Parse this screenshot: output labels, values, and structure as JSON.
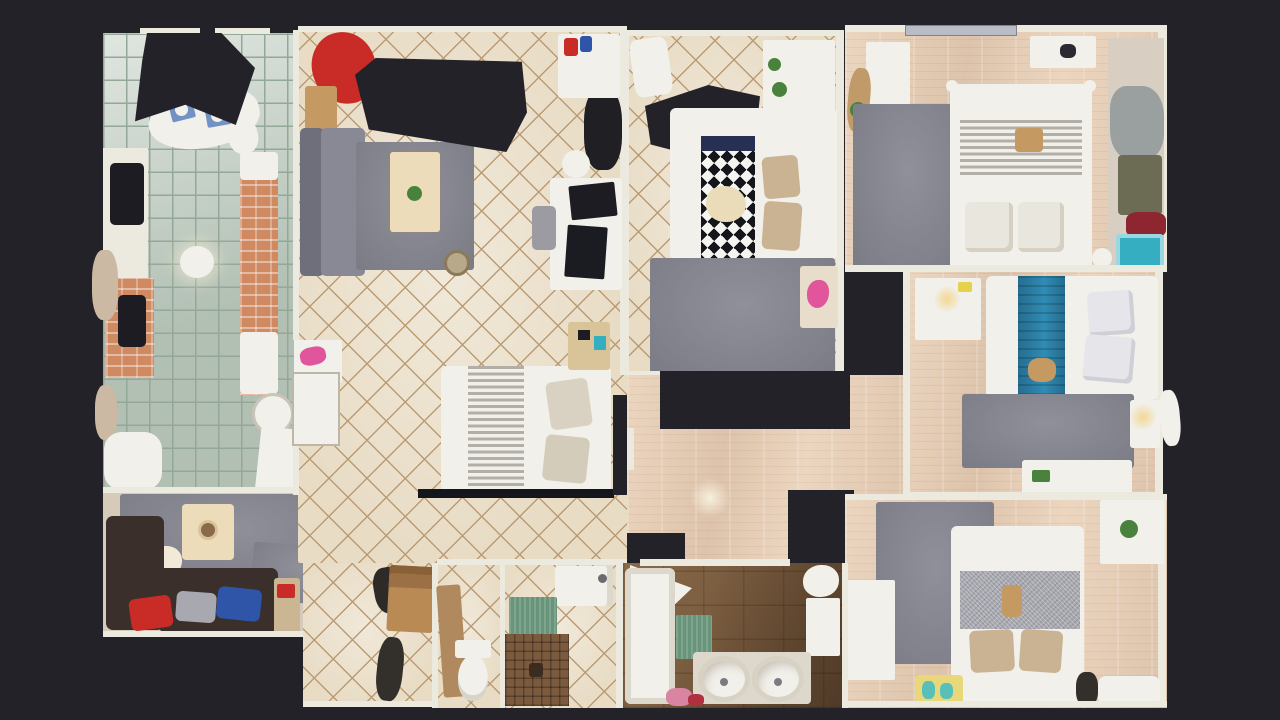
{
  "scene": {
    "description": "Top-down dollhouse floor plan of a 3D-scanned apartment on a dark background",
    "view": "floorplan-top-down"
  },
  "colors": {
    "bg": "#232228",
    "wall": "#eceade",
    "tileBeige": "#e8dcc5",
    "tileLine": "#bb9b74",
    "tileSage": "#c6d2c7",
    "sageLine": "#93a897",
    "wood": "#ddc3ab",
    "woodLight": "#ecd6c0",
    "rug": "#90909a",
    "rugDark": "#7b7b85",
    "sofaBack": "#6e6f7b",
    "sofaSeat": "#888995",
    "denSofa": "#3a2f2a",
    "red": "#c92b26",
    "blue": "#2e55a8",
    "pillowGray": "#a8a8b0",
    "pillowBeige": "#c9b392",
    "cream": "#ecdcba",
    "bedWhite": "#f2f0ea",
    "stripeDark": "#b3afa6",
    "navy": "#273052",
    "triDark": "#15151c",
    "blueRunner": "#2b7da3",
    "brick": "#cf8a62",
    "greenMat": "#67947a",
    "mosaicBrown": "#7b5a3e",
    "bathFloor1": "#7c5e41",
    "bathFloor2": "#4f3a28",
    "plant": "#48823c",
    "lampWarm": "#f3d794",
    "metal": "#b9bcc4",
    "darkItem": "#1c1c22",
    "woodItem": "#c49a62",
    "teal": "#35aec2",
    "pink": "#e0559b",
    "olive": "#6c6b53",
    "maroon": "#8e2632"
  },
  "rooms": {
    "kitchen": {
      "label": "Kitchen and dining"
    },
    "den": {
      "label": "TV lounge"
    },
    "living": {
      "label": "Living room"
    },
    "hallTile": {
      "label": "Tiled hallway"
    },
    "wc": {
      "label": "WC"
    },
    "shower": {
      "label": "Shower room"
    },
    "bedCenter": {
      "label": "Bedroom with triangle-pattern throw"
    },
    "hallWood": {
      "label": "Wood hallway"
    },
    "master": {
      "label": "Master bedroom"
    },
    "bedMidRight": {
      "label": "Bedroom with blue throw"
    },
    "bedBottomRight": {
      "label": "Bedroom with gray-band bed"
    },
    "bath": {
      "label": "Bathroom with double sinks"
    }
  }
}
